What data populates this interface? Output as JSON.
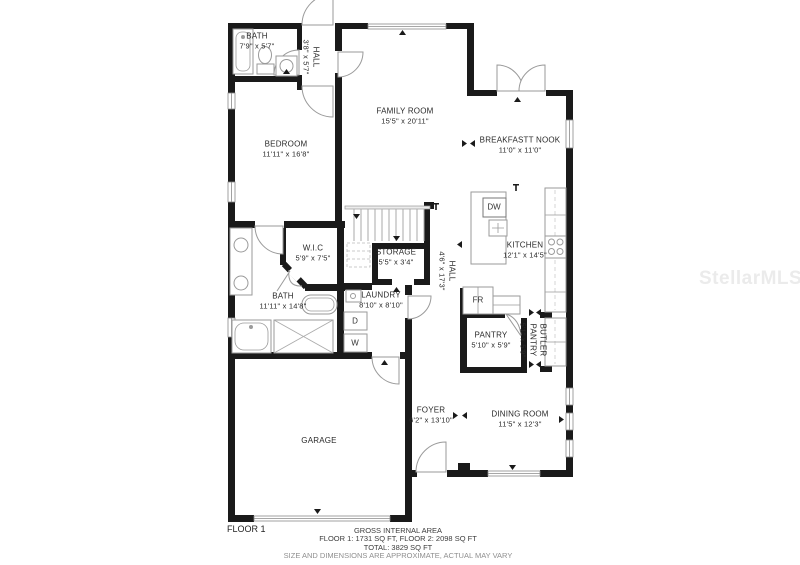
{
  "watermark": "StellarMLS",
  "floor_label": "FLOOR 1",
  "footer": {
    "line1": "GROSS INTERNAL AREA",
    "line2": "FLOOR 1: 1731 SQ FT, FLOOR 2: 2098 SQ FT",
    "line3": "TOTAL: 3829 SQ FT",
    "line4": "SIZE AND DIMENSIONS ARE APPROXIMATE, ACTUAL MAY VARY"
  },
  "rooms": [
    {
      "name": "BATH",
      "dims": "7'9\" x 5'7\""
    },
    {
      "name": "HALL",
      "dims": "3'8\" x 5'7\""
    },
    {
      "name": "FAMILY ROOM",
      "dims": "15'5\" x 20'11\""
    },
    {
      "name": "BREAKFASTT NOOK",
      "dims": "11'0\" x 11'0\""
    },
    {
      "name": "BEDROOM",
      "dims": "11'11\" x 16'8\""
    },
    {
      "name": "KITCHEN",
      "dims": "12'1\" x 14'5\""
    },
    {
      "name": "W.I.C",
      "dims": "5'9\" x 7'5\""
    },
    {
      "name": "STORAGE",
      "dims": "5'5\" x 3'4\""
    },
    {
      "name": "HALL",
      "dims": "4'6\" x 17'3\""
    },
    {
      "name": "BATH",
      "dims": "11'11\" x 14'8\""
    },
    {
      "name": "LAUNDRY",
      "dims": "8'10\" x 8'10\""
    },
    {
      "name": "PANTRY",
      "dims": "5'10\" x 5'9\""
    },
    {
      "name": "BUTLER PANTRY",
      "dims": "5'1\" x 5'9\""
    },
    {
      "name": "FOYER",
      "dims": "6'2\" x 13'10\""
    },
    {
      "name": "DINING ROOM",
      "dims": "11'5\" x 12'3\""
    },
    {
      "name": "GARAGE",
      "dims": ""
    }
  ],
  "appliances": {
    "dishwasher": "DW",
    "fridge": "FR",
    "dryer": "D",
    "washer": "W"
  },
  "colors": {
    "wall": "#1a1a1a",
    "fixture": "#9a9a9a",
    "label": "#2a2a2a",
    "watermark": "#ebebeb"
  }
}
